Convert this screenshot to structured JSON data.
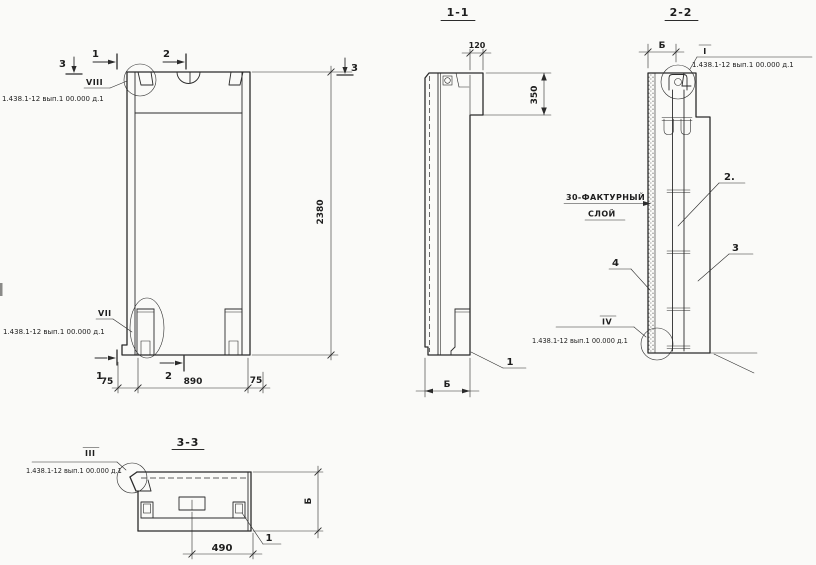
{
  "colors": {
    "paper": "#fafaf8",
    "ink": "#2b2b2b"
  },
  "ref_note": "1.438.1-12 вып.1 00.000 д.1",
  "elevation": {
    "detail_top": "VIII",
    "detail_bottom": "VII",
    "dim_height": "2380",
    "dim_left": "75",
    "dim_center": "890",
    "dim_right": "75",
    "mark_1": "1",
    "mark_2": "2",
    "mark_3": "3"
  },
  "section_1_1": {
    "title": "1-1",
    "dim_width": "120",
    "dim_depth": "350",
    "dim_thickness": "Б",
    "callout_support": "1"
  },
  "section_2_2": {
    "title": "2-2",
    "detail_top": "I",
    "detail_bottom": "IV",
    "dim_top": "Б",
    "facing_label_1": "30-ФАКТУРНЫЙ",
    "facing_label_2": "СЛОЙ",
    "callout_frame": "2.",
    "callout_panel": "3",
    "callout_facing": "4"
  },
  "section_3_3": {
    "title": "3-3",
    "detail": "III",
    "dim_opening": "490",
    "dim_thickness": "Б",
    "callout_support": "1"
  }
}
